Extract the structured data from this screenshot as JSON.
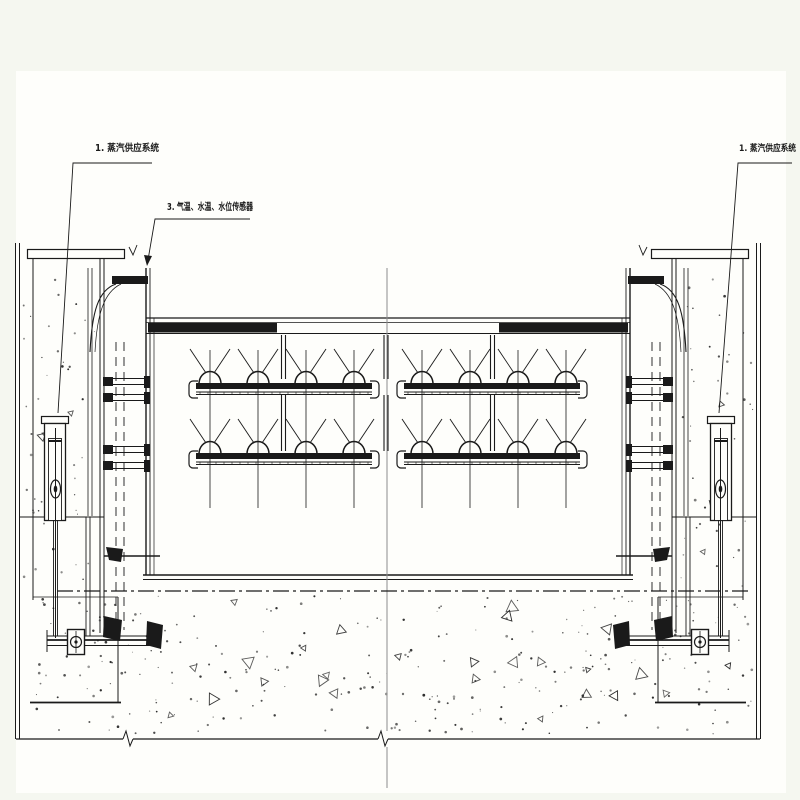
{
  "colors": {
    "background": "#f5f7f0",
    "paper": "#fefefb",
    "ink": "#1a1a1a",
    "centerline": "#8c8c8c"
  },
  "labels": {
    "steam_system_left": "1. 蒸汽供应系统",
    "sensors": "3. 气温、水温、水位传感器",
    "steam_system_right": "1. 蒸汽供应系统"
  }
}
